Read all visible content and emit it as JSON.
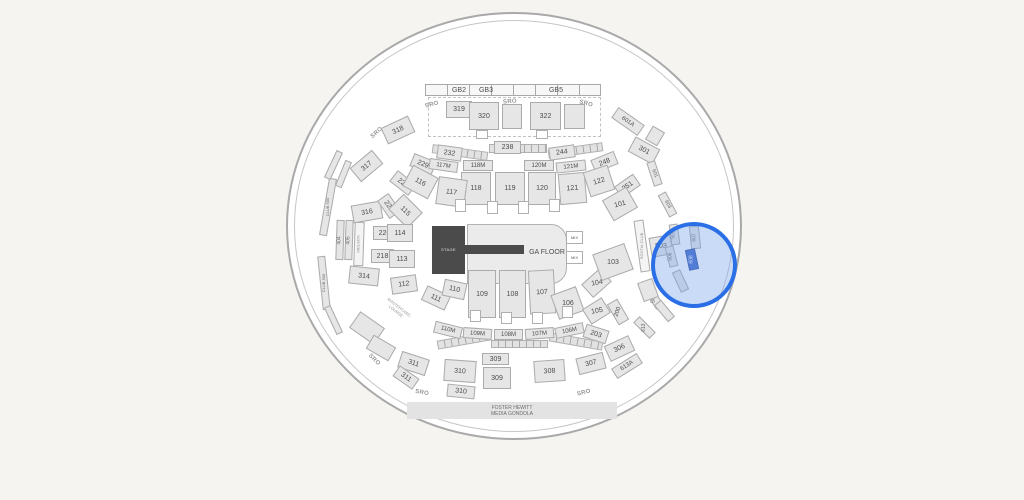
{
  "map": {
    "type": "arena-seating-map",
    "selected_section": "608",
    "highlight": {
      "stroke_color": "#2a6fe6",
      "fill_color": "rgba(120,166,235,0.40)",
      "center_x": 694,
      "center_y": 265,
      "radius": 43
    }
  },
  "sections": [
    {
      "t": "dash",
      "x": 428,
      "y": 97,
      "w": 173,
      "h": 40
    },
    {
      "t": "tickbar",
      "x": 425,
      "y": 84,
      "w": 176,
      "h": 12
    },
    {
      "t": "txt",
      "label": "GB2",
      "x": 447,
      "y": 85,
      "w": 24,
      "h": 10,
      "fs": 7
    },
    {
      "t": "txt",
      "label": "GB3",
      "x": 474,
      "y": 85,
      "w": 24,
      "h": 10,
      "fs": 7
    },
    {
      "t": "txt",
      "label": "GB5",
      "x": 544,
      "y": 85,
      "w": 24,
      "h": 10,
      "fs": 7
    },
    {
      "t": "tick",
      "x": 432,
      "y": 148,
      "w": 56,
      "h": 9,
      "r": 8
    },
    {
      "t": "tick",
      "x": 489,
      "y": 144,
      "w": 58,
      "h": 9
    },
    {
      "t": "tick",
      "x": 548,
      "y": 146,
      "w": 55,
      "h": 9,
      "r": -8
    },
    {
      "t": "tick",
      "x": 437,
      "y": 336,
      "w": 54,
      "h": 9,
      "r": -10
    },
    {
      "t": "tick",
      "x": 491,
      "y": 340,
      "w": 57,
      "h": 8
    },
    {
      "t": "tick",
      "x": 549,
      "y": 337,
      "w": 54,
      "h": 9,
      "r": 10
    },
    {
      "t": "sec",
      "label": "319",
      "x": 446,
      "y": 101,
      "w": 26,
      "h": 17
    },
    {
      "t": "sec",
      "label": "320",
      "x": 469,
      "y": 102,
      "w": 30,
      "h": 28
    },
    {
      "t": "sec",
      "x": 502,
      "y": 104,
      "w": 20,
      "h": 25
    },
    {
      "t": "sec",
      "label": "322",
      "x": 530,
      "y": 102,
      "w": 31,
      "h": 28
    },
    {
      "t": "sec",
      "x": 564,
      "y": 104,
      "w": 21,
      "h": 25
    },
    {
      "t": "portal",
      "x": 476,
      "y": 130,
      "w": 12,
      "h": 9
    },
    {
      "t": "portal",
      "x": 536,
      "y": 130,
      "w": 12,
      "h": 9
    },
    {
      "t": "sro",
      "label": "SRO",
      "x": 420,
      "y": 100,
      "w": 24,
      "h": 10,
      "r": -15
    },
    {
      "t": "sro",
      "label": "SRO",
      "x": 498,
      "y": 97,
      "w": 24,
      "h": 10,
      "r": -5
    },
    {
      "t": "sro",
      "label": "SRO",
      "x": 574,
      "y": 99,
      "w": 24,
      "h": 10,
      "r": 15
    },
    {
      "t": "sro",
      "label": "SRO",
      "x": 365,
      "y": 128,
      "w": 24,
      "h": 10,
      "r": -42
    },
    {
      "t": "sec",
      "label": "318",
      "x": 383,
      "y": 121,
      "w": 30,
      "h": 18,
      "r": -25
    },
    {
      "t": "sec",
      "label": "317",
      "x": 352,
      "y": 157,
      "w": 29,
      "h": 18,
      "r": -40
    },
    {
      "t": "sec",
      "label": "316",
      "x": 352,
      "y": 203,
      "w": 30,
      "h": 18,
      "r": -10
    },
    {
      "t": "sec",
      "label": "314",
      "x": 349,
      "y": 267,
      "w": 30,
      "h": 18,
      "r": 6
    },
    {
      "t": "strip",
      "label": "CLUB 500",
      "x": 324,
      "y": 178,
      "w": 8,
      "h": 58,
      "r": 10,
      "lr": -90,
      "fs": 4
    },
    {
      "t": "strip",
      "label": "CLUB 500",
      "x": 320,
      "y": 256,
      "w": 8,
      "h": 54,
      "r": -6,
      "lr": -90,
      "fs": 4
    },
    {
      "t": "strip",
      "x": 330,
      "y": 150,
      "w": 7,
      "h": 30,
      "r": 25
    },
    {
      "t": "strip",
      "x": 330,
      "y": 305,
      "w": 7,
      "h": 30,
      "r": -25
    },
    {
      "t": "strip",
      "x": 340,
      "y": 160,
      "w": 7,
      "h": 28,
      "r": 22
    },
    {
      "t": "strip",
      "label": "404",
      "x": 336,
      "y": 220,
      "w": 8,
      "h": 40,
      "r": 2,
      "lr": -90,
      "fs": 5
    },
    {
      "t": "strip",
      "label": "405",
      "x": 345,
      "y": 220,
      "w": 8,
      "h": 40,
      "r": 2,
      "lr": -90,
      "fs": 5
    },
    {
      "t": "stripw",
      "label": "MOLSON",
      "x": 354,
      "y": 222,
      "w": 10,
      "h": 44,
      "r": 2,
      "lr": -90,
      "fs": 4
    },
    {
      "t": "sec",
      "label": "232",
      "x": 437,
      "y": 146,
      "w": 25,
      "h": 14,
      "r": 8
    },
    {
      "t": "sec",
      "label": "229",
      "x": 411,
      "y": 157,
      "w": 24,
      "h": 14,
      "r": 22
    },
    {
      "t": "sec",
      "label": "226",
      "x": 391,
      "y": 176,
      "w": 24,
      "h": 14,
      "r": 38
    },
    {
      "t": "sec",
      "label": "223",
      "x": 378,
      "y": 199,
      "w": 22,
      "h": 14,
      "r": 55
    },
    {
      "t": "sec",
      "label": "220",
      "x": 373,
      "y": 226,
      "w": 23,
      "h": 14
    },
    {
      "t": "sec",
      "label": "218",
      "x": 371,
      "y": 249,
      "w": 23,
      "h": 14
    },
    {
      "t": "sec",
      "label": "238",
      "x": 494,
      "y": 141,
      "w": 27,
      "h": 13
    },
    {
      "t": "sec",
      "label": "244",
      "x": 549,
      "y": 146,
      "w": 26,
      "h": 13,
      "r": -8
    },
    {
      "t": "sec",
      "label": "248",
      "x": 592,
      "y": 155,
      "w": 25,
      "h": 14,
      "r": -22
    },
    {
      "t": "sec",
      "label": "251",
      "x": 616,
      "y": 179,
      "w": 23,
      "h": 14,
      "r": -35
    },
    {
      "t": "sec",
      "label": "203",
      "x": 584,
      "y": 327,
      "w": 24,
      "h": 14,
      "r": 18
    },
    {
      "t": "sec",
      "label": "200",
      "x": 612,
      "y": 300,
      "w": 12,
      "h": 24,
      "r": -30,
      "lr": -70,
      "fs": 6
    },
    {
      "t": "sec",
      "label": "117M",
      "x": 429,
      "y": 160,
      "w": 29,
      "h": 11,
      "r": 8,
      "fs": 6
    },
    {
      "t": "sec",
      "label": "118M",
      "x": 463,
      "y": 160,
      "w": 30,
      "h": 11,
      "fs": 6
    },
    {
      "t": "sec",
      "label": "120M",
      "x": 524,
      "y": 160,
      "w": 30,
      "h": 11,
      "fs": 6
    },
    {
      "t": "sec",
      "label": "121M",
      "x": 556,
      "y": 161,
      "w": 30,
      "h": 11,
      "r": -6,
      "fs": 6
    },
    {
      "t": "sec",
      "label": "118",
      "x": 461,
      "y": 172,
      "w": 30,
      "h": 33
    },
    {
      "t": "sec",
      "label": "119",
      "x": 495,
      "y": 172,
      "w": 30,
      "h": 33
    },
    {
      "t": "sec",
      "label": "120",
      "x": 528,
      "y": 172,
      "w": 28,
      "h": 33
    },
    {
      "t": "sec",
      "label": "121",
      "x": 559,
      "y": 173,
      "w": 27,
      "h": 31,
      "r": -5
    },
    {
      "t": "sec",
      "label": "122",
      "x": 586,
      "y": 168,
      "w": 26,
      "h": 26,
      "r": -18
    },
    {
      "t": "sec",
      "label": "116",
      "x": 406,
      "y": 170,
      "w": 29,
      "h": 24,
      "r": 28
    },
    {
      "t": "sec",
      "label": "117",
      "x": 437,
      "y": 178,
      "w": 29,
      "h": 28,
      "r": 8
    },
    {
      "t": "sec",
      "label": "115",
      "x": 392,
      "y": 200,
      "w": 27,
      "h": 22,
      "r": 45
    },
    {
      "t": "sec",
      "label": "114",
      "x": 387,
      "y": 224,
      "w": 26,
      "h": 18
    },
    {
      "t": "sec",
      "label": "113",
      "x": 389,
      "y": 250,
      "w": 26,
      "h": 18
    },
    {
      "t": "sec",
      "label": "112",
      "x": 391,
      "y": 276,
      "w": 26,
      "h": 17,
      "r": -8
    },
    {
      "t": "sec",
      "label": "111",
      "x": 423,
      "y": 290,
      "w": 26,
      "h": 16,
      "r": 25
    },
    {
      "t": "sec",
      "label": "110",
      "x": 443,
      "y": 281,
      "w": 23,
      "h": 17,
      "r": 12
    },
    {
      "t": "portal",
      "x": 455,
      "y": 199,
      "w": 11,
      "h": 13
    },
    {
      "t": "portal",
      "x": 487,
      "y": 201,
      "w": 11,
      "h": 13
    },
    {
      "t": "portal",
      "x": 518,
      "y": 201,
      "w": 11,
      "h": 13
    },
    {
      "t": "portal",
      "x": 549,
      "y": 199,
      "w": 11,
      "h": 13
    },
    {
      "t": "floor",
      "x": 467,
      "y": 224,
      "w": 100,
      "h": 60
    },
    {
      "t": "runway",
      "x": 464,
      "y": 245,
      "w": 60,
      "h": 9
    },
    {
      "t": "stage",
      "label": "STAGE",
      "x": 432,
      "y": 226,
      "w": 33,
      "h": 48,
      "fs": 4
    },
    {
      "t": "txtd",
      "label": "GA FLOOR",
      "x": 522,
      "y": 246,
      "w": 50,
      "h": 12,
      "fs": 7
    },
    {
      "t": "mix",
      "label": "MIX",
      "x": 566,
      "y": 231,
      "w": 17,
      "h": 13,
      "fs": 4
    },
    {
      "t": "mix",
      "label": "MIX",
      "x": 566,
      "y": 251,
      "w": 17,
      "h": 13,
      "fs": 4
    },
    {
      "t": "sec",
      "label": "109",
      "x": 468,
      "y": 270,
      "w": 28,
      "h": 48
    },
    {
      "t": "sec",
      "label": "108",
      "x": 499,
      "y": 270,
      "w": 27,
      "h": 48
    },
    {
      "t": "sec",
      "label": "107",
      "x": 529,
      "y": 270,
      "w": 26,
      "h": 44,
      "r": -3
    },
    {
      "t": "sec",
      "label": "106",
      "x": 554,
      "y": 290,
      "w": 27,
      "h": 26,
      "r": -20,
      "lr": 0
    },
    {
      "t": "sec",
      "label": "105",
      "x": 585,
      "y": 302,
      "w": 23,
      "h": 18,
      "r": -32,
      "lr": -10
    },
    {
      "t": "sec",
      "label": "104",
      "x": 584,
      "y": 274,
      "w": 25,
      "h": 18,
      "r": -42,
      "lr": -10
    },
    {
      "t": "sec",
      "label": "103",
      "x": 596,
      "y": 248,
      "w": 34,
      "h": 28,
      "r": -20,
      "lr": 0
    },
    {
      "t": "sec",
      "label": "101",
      "x": 606,
      "y": 192,
      "w": 28,
      "h": 24,
      "r": -30,
      "lr": -15
    },
    {
      "t": "portal",
      "x": 470,
      "y": 310,
      "w": 11,
      "h": 12
    },
    {
      "t": "portal",
      "x": 501,
      "y": 312,
      "w": 11,
      "h": 12
    },
    {
      "t": "portal",
      "x": 532,
      "y": 312,
      "w": 11,
      "h": 12
    },
    {
      "t": "portal",
      "x": 562,
      "y": 306,
      "w": 11,
      "h": 12
    },
    {
      "t": "sec",
      "label": "110M",
      "x": 434,
      "y": 324,
      "w": 28,
      "h": 12,
      "r": 14,
      "fs": 6
    },
    {
      "t": "sec",
      "label": "109M",
      "x": 463,
      "y": 328,
      "w": 29,
      "h": 11,
      "r": 4,
      "fs": 6
    },
    {
      "t": "sec",
      "label": "108M",
      "x": 494,
      "y": 329,
      "w": 29,
      "h": 11,
      "fs": 6
    },
    {
      "t": "sec",
      "label": "107M",
      "x": 525,
      "y": 328,
      "w": 29,
      "h": 11,
      "r": -4,
      "fs": 6
    },
    {
      "t": "sec",
      "label": "106M",
      "x": 555,
      "y": 325,
      "w": 29,
      "h": 11,
      "r": -12,
      "fs": 6
    },
    {
      "t": "sec",
      "label": "311",
      "x": 399,
      "y": 355,
      "w": 29,
      "h": 17,
      "r": 18
    },
    {
      "t": "sec",
      "label": "311",
      "x": 394,
      "y": 371,
      "w": 24,
      "h": 13,
      "r": 35
    },
    {
      "t": "sec",
      "label": "310",
      "x": 444,
      "y": 360,
      "w": 32,
      "h": 22,
      "r": 4
    },
    {
      "t": "sec",
      "label": "310",
      "x": 447,
      "y": 385,
      "w": 28,
      "h": 13,
      "r": 6
    },
    {
      "t": "sec",
      "label": "309",
      "x": 482,
      "y": 353,
      "w": 27,
      "h": 12
    },
    {
      "t": "sec",
      "label": "309",
      "x": 483,
      "y": 367,
      "w": 28,
      "h": 22
    },
    {
      "t": "sec",
      "label": "308",
      "x": 534,
      "y": 360,
      "w": 31,
      "h": 22,
      "r": -4
    },
    {
      "t": "sec",
      "label": "307",
      "x": 577,
      "y": 355,
      "w": 28,
      "h": 17,
      "r": -14
    },
    {
      "t": "sec",
      "label": "306",
      "x": 606,
      "y": 340,
      "w": 27,
      "h": 17,
      "r": -25
    },
    {
      "t": "sec",
      "x": 352,
      "y": 318,
      "w": 30,
      "h": 20,
      "r": 35
    },
    {
      "t": "sec",
      "x": 368,
      "y": 340,
      "w": 26,
      "h": 16,
      "r": 30
    },
    {
      "t": "sro",
      "label": "SRO",
      "x": 362,
      "y": 355,
      "w": 24,
      "h": 10,
      "r": 45
    },
    {
      "t": "sro",
      "label": "SRO",
      "x": 410,
      "y": 388,
      "w": 24,
      "h": 10,
      "r": 10
    },
    {
      "t": "sro",
      "label": "SRO",
      "x": 572,
      "y": 388,
      "w": 24,
      "h": 10,
      "r": -14
    },
    {
      "t": "txt2",
      "label": "MASTERCARD|LOUNGE",
      "x": 372,
      "y": 300,
      "w": 50,
      "h": 20,
      "r": 38,
      "fs": 4
    },
    {
      "t": "sec",
      "label": "601A",
      "x": 612,
      "y": 115,
      "w": 32,
      "h": 13,
      "r": 35,
      "fs": 6
    },
    {
      "t": "sec",
      "label": "301",
      "x": 630,
      "y": 142,
      "w": 28,
      "h": 17,
      "r": 28
    },
    {
      "t": "sec",
      "x": 648,
      "y": 128,
      "w": 14,
      "h": 16,
      "r": 30
    },
    {
      "t": "strip",
      "label": "601",
      "x": 650,
      "y": 161,
      "w": 9,
      "h": 25,
      "r": -18,
      "lr": 70,
      "fs": 5
    },
    {
      "t": "strip",
      "label": "603",
      "x": 663,
      "y": 192,
      "w": 9,
      "h": 25,
      "r": -28,
      "lr": 60,
      "fs": 5
    },
    {
      "t": "stripw",
      "label": "SCOTIA CLUB",
      "x": 637,
      "y": 220,
      "w": 10,
      "h": 52,
      "r": -8,
      "lr": -90,
      "fs": 4
    },
    {
      "t": "sec",
      "label": "503",
      "x": 650,
      "y": 236,
      "w": 22,
      "h": 20,
      "r": -10,
      "lr": 0
    },
    {
      "t": "strip",
      "label": "505",
      "x": 670,
      "y": 224,
      "w": 9,
      "h": 21,
      "r": -8,
      "lr": -90,
      "fs": 5
    },
    {
      "t": "strip",
      "label": "506",
      "x": 667,
      "y": 246,
      "w": 9,
      "h": 21,
      "r": -14,
      "lr": -90,
      "fs": 5
    },
    {
      "t": "strip",
      "label": "607",
      "x": 690,
      "y": 226,
      "w": 10,
      "h": 23,
      "r": -6,
      "lr": -90,
      "fs": 5
    },
    {
      "t": "sel",
      "label": "608",
      "x": 687,
      "y": 249,
      "w": 10,
      "h": 21,
      "r": -12,
      "lr": -90,
      "fs": 5
    },
    {
      "t": "strip",
      "label": "509",
      "x": 650,
      "y": 288,
      "w": 9,
      "h": 21,
      "r": -32,
      "lr": -90,
      "fs": 5
    },
    {
      "t": "strip",
      "label": "613",
      "x": 640,
      "y": 316,
      "w": 9,
      "h": 23,
      "r": -45,
      "lr": -90,
      "fs": 5
    },
    {
      "t": "sec",
      "label": "613A",
      "x": 612,
      "y": 360,
      "w": 30,
      "h": 12,
      "r": -32,
      "fs": 6
    },
    {
      "t": "strip",
      "x": 676,
      "y": 270,
      "w": 9,
      "h": 22,
      "r": -25
    },
    {
      "t": "strip",
      "x": 660,
      "y": 300,
      "w": 9,
      "h": 22,
      "r": -40
    },
    {
      "t": "sec",
      "x": 640,
      "y": 280,
      "w": 16,
      "h": 20,
      "r": -20
    },
    {
      "t": "fhbar",
      "label": "FOSTER HEWITT|MEDIA GONDOLA",
      "x": 407,
      "y": 402,
      "w": 210,
      "h": 17,
      "fs": 5
    }
  ]
}
